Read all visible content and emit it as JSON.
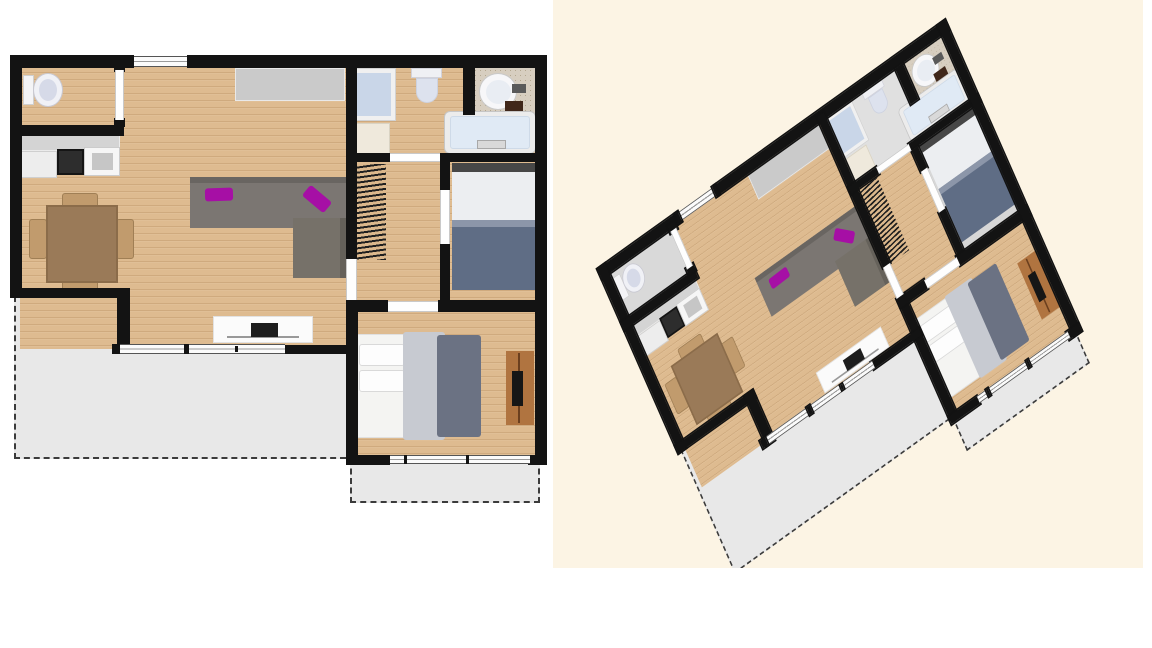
{
  "background": "#ffffff",
  "colors": {
    "wall": "#131313",
    "wood_floor": "#debb90",
    "terrace_gray": "#e8e8e8",
    "accent_magenta": "#a60fa5",
    "sofa_gray": "#7b7672",
    "bed_blanket_blue": "#5f6d85",
    "panel_cream": "#fcf4e4"
  },
  "panel_3d": {
    "x": 553,
    "y": 0,
    "width": 590,
    "height": 568,
    "background": "#fcf4e4"
  },
  "transform_3d": {
    "matrix": [
      0.6475,
      -0.4639,
      0.3333,
      0.7584,
      19.6,
      232
    ]
  },
  "floor_overrides_3d": {
    "floor-wc": "#d9d9d9",
    "floor-bathroom": "#e0e0e0",
    "floor-bedroom-1": "#d7d7d7"
  },
  "plan_items": [
    {
      "n": "terrace-living",
      "c": "terrace dash-l dash-b",
      "x": 14,
      "y": 296,
      "w": 332,
      "h": 163
    },
    {
      "n": "terrace-bedroom",
      "c": "terrace dash-l dash-b dash-r",
      "x": 350,
      "y": 459,
      "w": 190,
      "h": 44
    },
    {
      "n": "floor-living-room",
      "c": "wood",
      "x": 20,
      "y": 65,
      "w": 327,
      "h": 284
    },
    {
      "n": "floor-wc",
      "c": "wood",
      "x": 20,
      "y": 65,
      "w": 100,
      "h": 62
    },
    {
      "n": "floor-bathroom",
      "c": "wood",
      "x": 350,
      "y": 65,
      "w": 187,
      "h": 92
    },
    {
      "n": "floor-hallway",
      "c": "wood",
      "x": 350,
      "y": 157,
      "w": 92,
      "h": 148
    },
    {
      "n": "floor-bedroom-1",
      "c": "wood",
      "x": 442,
      "y": 157,
      "w": 95,
      "h": 147
    },
    {
      "n": "floor-bedroom-2",
      "c": "wood",
      "x": 352,
      "y": 306,
      "w": 185,
      "h": 153
    },
    {
      "n": "stairs",
      "c": "hatch",
      "x": 354,
      "y": 164,
      "w": 32,
      "h": 96
    },
    {
      "n": "kitchen-counter",
      "x": 18,
      "y": 130,
      "w": 102,
      "h": 21,
      "bg": "#d4d4d4",
      "bd": "1px solid #ebebeb"
    },
    {
      "n": "kitchen-fridge",
      "c": "lines3",
      "x": 18,
      "y": 151,
      "w": 39,
      "h": 27,
      "bg": "#ededed",
      "bd": "1px solid #cfcfcf"
    },
    {
      "n": "kitchen-stove",
      "x": 57,
      "y": 149,
      "w": 27,
      "h": 26,
      "bg": "#2d2d2d",
      "bd": "2px solid #151515"
    },
    {
      "n": "kitchen-sink",
      "x": 84,
      "y": 147,
      "w": 36,
      "h": 29,
      "bg": "#f6f6f6",
      "bd": "1px solid #cccccc"
    },
    {
      "n": "kitchen-sink-basin",
      "x": 92,
      "y": 153,
      "w": 21,
      "h": 17,
      "bg": "#c6c6c6"
    },
    {
      "n": "closet-sideboard",
      "x": 235,
      "y": 68,
      "w": 110,
      "h": 33,
      "bg": "#cacaca",
      "bd": "1px solid #e9e9e9"
    },
    {
      "n": "toilet-wc-tank",
      "x": 23,
      "y": 75,
      "w": 11,
      "h": 30,
      "bg": "#f4f4f6",
      "bd": "1px solid #cfcfcf"
    },
    {
      "n": "toilet-wc-bowl",
      "c": "round",
      "x": 33,
      "y": 73,
      "w": 30,
      "h": 34,
      "bg": "#f0f1f6",
      "bd": "1px solid #c9c9d2"
    },
    {
      "n": "toilet-wc-seat",
      "c": "round",
      "x": 39,
      "y": 79,
      "w": 18,
      "h": 22,
      "bg": "#d6dae8"
    },
    {
      "n": "sofa-main",
      "c": "sh-top",
      "x": 190,
      "y": 177,
      "w": 156,
      "h": 51,
      "bg": "#7b7672"
    },
    {
      "n": "sofa-chaise",
      "c": "sh-right",
      "x": 293,
      "y": 218,
      "w": 53,
      "h": 60,
      "bg": "#767169"
    },
    {
      "n": "sofa-cushion-1",
      "c": "cushion",
      "x": 205,
      "y": 188,
      "w": 28,
      "h": 13,
      "rot": -2
    },
    {
      "n": "sofa-cushion-2",
      "c": "cushion",
      "x": 303,
      "y": 192,
      "w": 28,
      "h": 14,
      "rot": 40
    },
    {
      "n": "tv-stand",
      "x": 213,
      "y": 316,
      "w": 100,
      "h": 27,
      "bg": "#fbfbfb",
      "bd": "1px solid #e2e2e2"
    },
    {
      "n": "tv-shelf-line",
      "x": 227,
      "y": 336,
      "w": 72,
      "h": 2,
      "bg": "#999999"
    },
    {
      "n": "tv-screen",
      "x": 251,
      "y": 323,
      "w": 27,
      "h": 14,
      "bg": "#1d1d1d"
    },
    {
      "n": "dining-chair-top",
      "c": "chair",
      "x": 62,
      "y": 193,
      "w": 36,
      "h": 17
    },
    {
      "n": "dining-chair-bottom",
      "c": "chair",
      "x": 62,
      "y": 279,
      "w": 36,
      "h": 18
    },
    {
      "n": "dining-chair-left",
      "c": "chair",
      "x": 29,
      "y": 219,
      "w": 18,
      "h": 40
    },
    {
      "n": "dining-chair-right",
      "c": "chair",
      "x": 116,
      "y": 219,
      "w": 18,
      "h": 40
    },
    {
      "n": "dining-table",
      "x": 46,
      "y": 205,
      "w": 72,
      "h": 78,
      "bg": "#9a7a58",
      "bd": "2px solid #8b6c4a"
    },
    {
      "n": "shower",
      "x": 352,
      "y": 68,
      "w": 44,
      "h": 53,
      "bg": "#f0f0f0",
      "bd": "1px solid #d2d2d2"
    },
    {
      "n": "shower-tray",
      "x": 357,
      "y": 73,
      "w": 34,
      "h": 43,
      "bg": "#c9d6e8"
    },
    {
      "n": "bathroom-cabinet",
      "x": 352,
      "y": 123,
      "w": 38,
      "h": 33,
      "bg": "#efe9dc",
      "bd": "1px solid #d9d3c3"
    },
    {
      "n": "toilet-bath-tank",
      "x": 411,
      "y": 68,
      "w": 31,
      "h": 10,
      "bg": "#eff0f4",
      "bd": "1px solid #d2d2da"
    },
    {
      "n": "toilet-bath-bowl",
      "c": "bowl",
      "x": 416,
      "y": 78,
      "w": 22,
      "h": 25,
      "bg": "#dde2ee",
      "bd": "1px solid #cdd2e0"
    },
    {
      "n": "vanity-counter",
      "c": "speckle",
      "x": 473,
      "y": 68,
      "w": 62,
      "h": 47
    },
    {
      "n": "vanity-sink",
      "c": "round",
      "x": 479,
      "y": 73,
      "w": 38,
      "h": 37,
      "bg": "#f7f7f9",
      "bd": "1px solid #c9c9c9"
    },
    {
      "n": "vanity-sink-inner",
      "c": "round",
      "x": 486,
      "y": 80,
      "w": 25,
      "h": 24,
      "bg": "#e9edf3"
    },
    {
      "n": "vanity-faucet",
      "x": 512,
      "y": 84,
      "w": 14,
      "h": 9,
      "bg": "#5a5a5a"
    },
    {
      "n": "vanity-dark-box",
      "x": 505,
      "y": 101,
      "w": 18,
      "h": 15,
      "bg": "#40271a"
    },
    {
      "n": "bathtub",
      "c": "r6",
      "x": 444,
      "y": 111,
      "w": 92,
      "h": 43,
      "bg": "#ececec",
      "bd": "1px solid #c6c6c6"
    },
    {
      "n": "bathtub-inner",
      "c": "r3",
      "x": 450,
      "y": 116,
      "w": 80,
      "h": 33,
      "bg": "#e0eaf5",
      "bd": "1px solid #cedae8"
    },
    {
      "n": "bathtub-faucet",
      "x": 477,
      "y": 140,
      "w": 29,
      "h": 9,
      "bg": "#d9d9d9",
      "bd": "1px solid #a8a8a8"
    },
    {
      "n": "bed1-headboard",
      "x": 452,
      "y": 163,
      "w": 85,
      "h": 9,
      "bg": "#474747"
    },
    {
      "n": "bed1-mattress",
      "x": 452,
      "y": 172,
      "w": 85,
      "h": 50,
      "bg": "#eceef1"
    },
    {
      "n": "bed1-blanket",
      "x": 452,
      "y": 220,
      "w": 85,
      "h": 70,
      "bg": "#5f6d85"
    },
    {
      "n": "bed1-blanket-fold",
      "x": 452,
      "y": 220,
      "w": 85,
      "h": 7,
      "bg": "#8c96a9"
    },
    {
      "n": "bed2-mattress",
      "x": 354,
      "y": 334,
      "w": 58,
      "h": 104,
      "bg": "#f4f4f2",
      "bd": "1px solid #e0e0e0"
    },
    {
      "n": "bed2-pillow-1",
      "c": "r3",
      "x": 359,
      "y": 344,
      "w": 46,
      "h": 22,
      "bg": "#fdfdfd",
      "bd": "1px solid #d9d9d9"
    },
    {
      "n": "bed2-pillow-2",
      "c": "r3",
      "x": 359,
      "y": 370,
      "w": 46,
      "h": 22,
      "bg": "#fdfdfd",
      "bd": "1px solid #d9d9d9"
    },
    {
      "n": "bed2-duvet",
      "c": "r3",
      "x": 403,
      "y": 332,
      "w": 42,
      "h": 108,
      "bg": "#c7cad1"
    },
    {
      "n": "bed2-blanket",
      "c": "r3",
      "x": 437,
      "y": 335,
      "w": 44,
      "h": 102,
      "bg": "#6b7283"
    },
    {
      "n": "bedroom2-desk",
      "x": 506,
      "y": 351,
      "w": 28,
      "h": 74,
      "bg": "#b07440"
    },
    {
      "n": "desk-edge-line",
      "x": 518,
      "y": 353,
      "w": 2,
      "h": 70,
      "bg": "#6b3f1e"
    },
    {
      "n": "desk-tv",
      "x": 512,
      "y": 371,
      "w": 11,
      "h": 35,
      "bg": "#161616"
    },
    {
      "n": "wall-top-left",
      "c": "wall",
      "x": 10,
      "y": 55,
      "w": 123,
      "h": 13
    },
    {
      "n": "wall-top-right",
      "c": "wall",
      "x": 190,
      "y": 55,
      "w": 357,
      "h": 13
    },
    {
      "n": "wall-left",
      "c": "wall",
      "x": 10,
      "y": 55,
      "w": 12,
      "h": 243
    },
    {
      "n": "wall-step-h",
      "c": "wall",
      "x": 10,
      "y": 288,
      "w": 120,
      "h": 10
    },
    {
      "n": "wall-step-v",
      "c": "wall",
      "x": 117,
      "y": 288,
      "w": 13,
      "h": 66
    },
    {
      "n": "wall-wc-bottom",
      "c": "wall",
      "x": 10,
      "y": 125,
      "w": 114,
      "h": 11
    },
    {
      "n": "wall-living-right",
      "c": "wall",
      "x": 346,
      "y": 60,
      "w": 11,
      "h": 199
    },
    {
      "n": "wall-living-right-low",
      "c": "wall",
      "x": 346,
      "y": 300,
      "w": 12,
      "h": 159
    },
    {
      "n": "wall-living-bottom",
      "c": "wall",
      "x": 283,
      "y": 345,
      "w": 74,
      "h": 9
    },
    {
      "n": "wall-bath-bottom-left",
      "c": "wall",
      "x": 347,
      "y": 153,
      "w": 43,
      "h": 9
    },
    {
      "n": "wall-bath-bottom-right",
      "c": "wall",
      "x": 440,
      "y": 153,
      "w": 107,
      "h": 9
    },
    {
      "n": "wall-bath-inner",
      "c": "wall",
      "x": 463,
      "y": 68,
      "w": 12,
      "h": 47
    },
    {
      "n": "wall-bed1-left-top",
      "c": "wall",
      "x": 440,
      "y": 162,
      "w": 10,
      "h": 28
    },
    {
      "n": "wall-bed1-left-bottom",
      "c": "wall",
      "x": 440,
      "y": 244,
      "w": 10,
      "h": 58
    },
    {
      "n": "wall-mid-left",
      "c": "wall",
      "x": 346,
      "y": 300,
      "w": 42,
      "h": 12
    },
    {
      "n": "wall-mid-right",
      "c": "wall",
      "x": 438,
      "y": 300,
      "w": 109,
      "h": 12
    },
    {
      "n": "wall-right-outer",
      "c": "wall",
      "x": 535,
      "y": 55,
      "w": 12,
      "h": 410
    },
    {
      "n": "wall-bed2-bottom-left",
      "c": "wall",
      "x": 346,
      "y": 455,
      "w": 44,
      "h": 10
    },
    {
      "n": "wall-bed2-bottom-right",
      "c": "wall",
      "x": 528,
      "y": 455,
      "w": 19,
      "h": 10
    },
    {
      "n": "post-wc-top",
      "c": "wall",
      "x": 114,
      "y": 62,
      "w": 11,
      "h": 10
    },
    {
      "n": "post-wc-bottom",
      "c": "wall",
      "x": 114,
      "y": 118,
      "w": 11,
      "h": 9
    },
    {
      "n": "window-top",
      "c": "winh",
      "x": 131,
      "y": 56,
      "w": 60,
      "h": 11
    },
    {
      "n": "post-window-top-left",
      "c": "wall",
      "x": 129,
      "y": 55,
      "w": 5,
      "h": 13
    },
    {
      "n": "post-window-top-right",
      "c": "wall",
      "x": 187,
      "y": 55,
      "w": 5,
      "h": 13
    },
    {
      "n": "door-wc",
      "c": "doorv",
      "x": 115,
      "y": 70,
      "w": 9,
      "h": 50
    },
    {
      "n": "window-living",
      "c": "winh",
      "x": 118,
      "y": 344,
      "w": 167,
      "h": 10
    },
    {
      "n": "post-window-living-left",
      "c": "wall",
      "x": 112,
      "y": 344,
      "w": 8,
      "h": 10
    },
    {
      "n": "window-living-divider",
      "c": "wall",
      "x": 184,
      "y": 344,
      "w": 5,
      "h": 10
    },
    {
      "n": "window-living-tick",
      "c": "wall",
      "x": 235,
      "y": 346,
      "w": 3,
      "h": 6
    },
    {
      "n": "window-bedroom2",
      "c": "winh",
      "x": 390,
      "y": 455,
      "w": 140,
      "h": 9
    },
    {
      "n": "window-bed2-tick-1",
      "c": "wall",
      "x": 404,
      "y": 455,
      "w": 3,
      "h": 9
    },
    {
      "n": "window-bed2-tick-2",
      "c": "wall",
      "x": 466,
      "y": 455,
      "w": 3,
      "h": 9
    },
    {
      "n": "door-bathroom",
      "c": "doorh",
      "x": 390,
      "y": 153,
      "w": 50,
      "h": 9
    },
    {
      "n": "door-bedroom-1",
      "c": "doorv",
      "x": 440,
      "y": 190,
      "w": 10,
      "h": 54
    },
    {
      "n": "door-bedroom-2",
      "c": "doorh",
      "x": 388,
      "y": 301,
      "w": 50,
      "h": 11
    },
    {
      "n": "door-living-hall",
      "c": "doorv",
      "x": 346,
      "y": 259,
      "w": 11,
      "h": 41
    }
  ]
}
